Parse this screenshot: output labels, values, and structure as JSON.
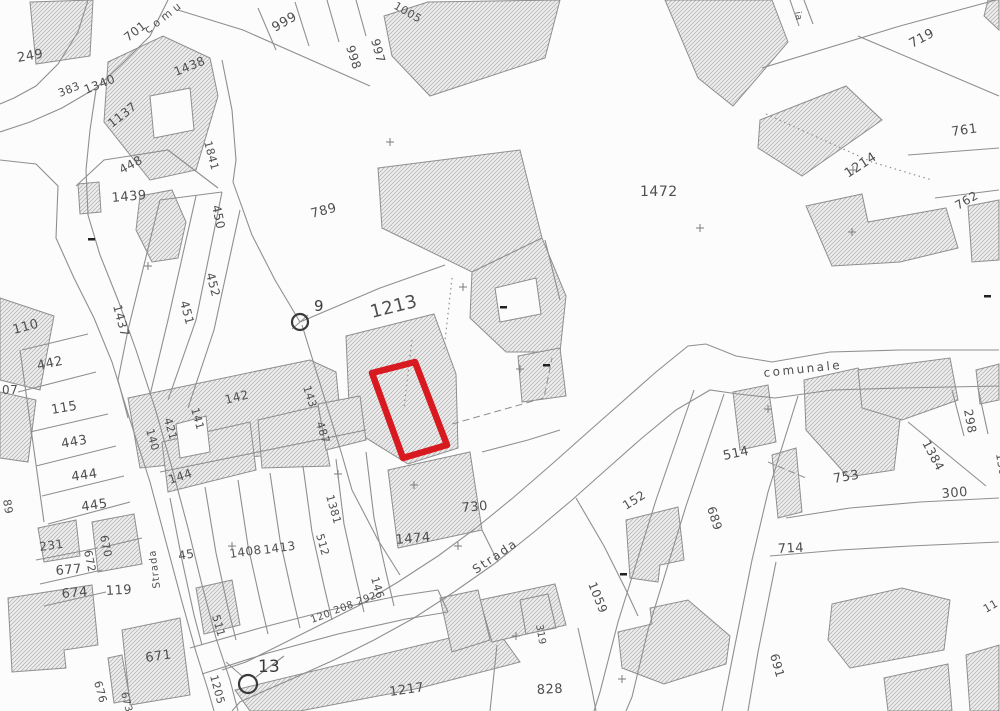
{
  "map": {
    "background": "#fcfcfc",
    "line_color": "#8f8f8f",
    "label_color": "#4f4f4f",
    "strong_label_color": "#3a3a3a",
    "hatch_bg": "#efefef",
    "hatch_stroke": "#b4b4b4",
    "highlight_color": "#d8191f",
    "red_parcel": "372,373 415,362 447,445 403,458",
    "buildings": [
      "30,2 93,0 90,56 36,64",
      "108,62 163,36 210,58 218,96 196,170 150,180 104,122",
      "384,16 428,2 560,0 545,58 430,96 392,56",
      "665,0 772,0 788,42 733,106 698,78",
      "760,120 846,86 882,120 802,176 758,148",
      "806,206 862,194 868,222 946,208 958,248 900,262 832,266",
      "968,206 999,200 999,260 972,262",
      "988,0 999,0 999,30 984,16",
      "378,168 520,150 542,238 472,272 382,228",
      "472,272 542,238 566,296 560,352 506,352 470,318",
      "346,336 434,314 456,374 458,448 408,464 350,428",
      "518,356 560,348 566,396 522,402",
      "388,470 470,452 482,530 398,548",
      "128,398 310,360 336,372 342,432 300,452 140,468",
      "0,298 54,316 40,390 0,380",
      "0,392 36,400 28,462 0,458",
      "78,184 99,182 101,212 80,214",
      "140,196 172,190 186,222 178,258 152,262 136,230",
      "38,528 76,520 80,556 44,562",
      "92,522 134,514 142,564 98,572",
      "8,598 92,585 98,645 64,650 66,668 12,672",
      "122,630 180,618 190,695 130,705",
      "108,658 122,655 130,700 114,703",
      "162,442 250,422 256,470 168,492",
      "258,420 318,406 330,466 262,468",
      "318,404 360,396 366,440 326,450",
      "196,588 232,580 240,625 204,634",
      "235,690 495,627 520,662 420,688 300,711 250,711",
      "480,600 555,584 566,625 492,642",
      "618,632 652,624 650,608 688,600 730,636 726,664 664,684 622,668",
      "832,604 902,588 950,600 944,650 850,668 828,640",
      "884,678 948,664 952,711 888,711",
      "966,655 999,645 999,711 970,711",
      "733,392 768,385 776,442 740,450",
      "804,380 858,368 900,420 894,470 848,477 806,430",
      "858,370 950,358 958,400 902,420 862,408",
      "772,455 796,448 802,512 778,518",
      "976,370 999,364 999,400 980,404",
      "626,520 678,507 684,560 660,565 658,582 630,578",
      "440,598 478,590 490,640 452,652"
    ],
    "holes": [
      "150,96 190,88 194,130 154,138",
      "176,424 206,416 210,452 180,458",
      "495,288 536,278 541,314 500,322"
    ],
    "lines": [
      "88,0 78,32 58,64 36,86 14,98 0,104",
      "168,0 150,36 122,64 96,88 62,108 30,122 0,132",
      "0,160 36,164 58,186 56,238 74,278 94,318 112,362 130,420 150,482 166,542 182,602 196,652 208,690 214,711",
      "96,90 90,130 86,170 88,215 100,255 118,300 136,350 155,408 172,468 188,528 202,585 216,638 230,680 238,711",
      "178,10 243,30 370,86",
      "258,8 276,50",
      "295,2 309,46",
      "327,0 339,42",
      "356,0 366,36",
      "222,60 232,110 236,160 233,182",
      "233,182 252,235 275,280 300,322",
      "76,186 104,160 168,150 218,188",
      "160,200 128,330 118,380 128,418",
      "196,196 168,320 150,395",
      "222,192 196,320 168,400",
      "240,210 214,330 188,408",
      "160,200 222,192",
      "300,322 380,288 445,265",
      "302,325 322,390 342,455 352,490",
      "999,350 900,350 830,352 772,362 736,356 706,344 688,346 656,372 622,402 588,432 552,464 514,497 476,528 438,556 398,582 358,606 318,626 278,646 246,662 222,670",
      "999,386 900,388 832,390 775,398 738,394 710,390 676,410 642,438 608,468 572,500 534,532 494,564 454,592 414,618 374,640 334,660 294,678 262,692 240,702 232,711",
      "190,648 260,628 330,610 398,596 438,590",
      "202,674 268,653 338,634 406,619 448,612",
      "762,68 900,26 996,0",
      "858,36 999,96",
      "908,155 999,148",
      "935,198 999,190",
      "694,390 656,500 618,622 600,692 594,711",
      "724,394 686,506 648,630 632,697 626,711",
      "798,396 768,492 752,560",
      "752,560 734,650 722,711",
      "776,562 758,652 748,711",
      "786,518 850,508 920,502 999,498",
      "770,556 840,550 910,546 999,542",
      "497,645 490,711",
      "578,628 592,690 596,711",
      "170,498 182,560 194,615 202,645",
      "205,487 216,553 228,608 236,640",
      "238,480 248,546 260,600 268,634",
      "270,473 280,540 292,594 300,628",
      "303,466 312,532 324,586 332,620",
      "336,459 344,524 356,578 364,612",
      "366,452 374,518 386,572 394,606",
      "160,472 366,430",
      "22,350 88,334",
      "18,392 96,372",
      "30,432 108,414",
      "36,466 116,446",
      "42,496 124,476",
      "48,524 130,502",
      "20,350 44,522",
      "36,560 98,548",
      "40,584 102,570",
      "44,606 106,592",
      "100,548 142,538",
      "352,490 378,540 400,575",
      "482,452 528,440 560,430",
      "576,498 604,546 626,590 638,616",
      "520,600 548,594 556,628 526,634 520,600",
      "908,422 986,486",
      "952,390 964,436",
      "978,388 988,434",
      "790,0 799,26",
      "804,0 813,24",
      "226,662 242,676",
      "256,677 284,656",
      "292,329 308,315",
      "482,530 498,562",
      "438,590 448,612",
      "545,240 560,300"
    ],
    "dashed": [
      "452,424 544,398 552,358",
      "768,462 806,478"
    ],
    "dotted": [
      "766,114 872,162 932,180",
      "452,278 444,350",
      "412,340 404,408"
    ],
    "labels": [
      {
        "t": "249",
        "x": 18,
        "y": 62,
        "r": -10,
        "s": 13
      },
      {
        "t": "701",
        "x": 128,
        "y": 42,
        "r": -38,
        "s": 12
      },
      {
        "t": "383",
        "x": 60,
        "y": 97,
        "r": -22,
        "s": 11
      },
      {
        "t": "1340",
        "x": 86,
        "y": 94,
        "r": -22,
        "s": 12
      },
      {
        "t": "1438",
        "x": 176,
        "y": 76,
        "r": -22,
        "s": 12
      },
      {
        "t": "1137",
        "x": 112,
        "y": 128,
        "r": -38,
        "s": 12
      },
      {
        "t": "1841",
        "x": 204,
        "y": 142,
        "r": 75,
        "s": 11
      },
      {
        "t": "999",
        "x": 275,
        "y": 32,
        "r": -30,
        "s": 13
      },
      {
        "t": "998",
        "x": 346,
        "y": 47,
        "r": 72,
        "s": 12
      },
      {
        "t": "997",
        "x": 371,
        "y": 40,
        "r": 75,
        "s": 12
      },
      {
        "t": "1005",
        "x": 393,
        "y": 8,
        "r": 30,
        "s": 11
      },
      {
        "t": "719",
        "x": 912,
        "y": 48,
        "r": -28,
        "s": 13
      },
      {
        "t": "ia",
        "x": 795,
        "y": 12,
        "r": 80,
        "s": 9
      },
      {
        "t": "761",
        "x": 952,
        "y": 136,
        "r": -8,
        "s": 13
      },
      {
        "t": "1214",
        "x": 848,
        "y": 178,
        "r": -33,
        "s": 13
      },
      {
        "t": "762",
        "x": 958,
        "y": 210,
        "r": -30,
        "s": 12
      },
      {
        "t": "1472",
        "x": 640,
        "y": 196,
        "r": 0,
        "s": 14
      },
      {
        "t": "789",
        "x": 312,
        "y": 218,
        "r": -15,
        "s": 13
      },
      {
        "t": "1213",
        "x": 372,
        "y": 318,
        "r": -14,
        "s": 18
      },
      {
        "t": "448",
        "x": 122,
        "y": 174,
        "r": -28,
        "s": 12
      },
      {
        "t": "1439",
        "x": 112,
        "y": 202,
        "r": -5,
        "s": 13
      },
      {
        "t": "450",
        "x": 212,
        "y": 206,
        "r": 78,
        "s": 12
      },
      {
        "t": "452",
        "x": 206,
        "y": 274,
        "r": 75,
        "s": 12
      },
      {
        "t": "451",
        "x": 180,
        "y": 302,
        "r": 75,
        "s": 12
      },
      {
        "t": "1437",
        "x": 113,
        "y": 306,
        "r": 75,
        "s": 12
      },
      {
        "t": "110",
        "x": 14,
        "y": 334,
        "r": -15,
        "s": 13
      },
      {
        "t": "442",
        "x": 38,
        "y": 370,
        "r": -12,
        "s": 13
      },
      {
        "t": "07",
        "x": 2,
        "y": 394,
        "r": 0,
        "s": 12
      },
      {
        "t": "115",
        "x": 52,
        "y": 414,
        "r": -10,
        "s": 13
      },
      {
        "t": "443",
        "x": 62,
        "y": 448,
        "r": -10,
        "s": 13
      },
      {
        "t": "444",
        "x": 72,
        "y": 481,
        "r": -8,
        "s": 13
      },
      {
        "t": "445",
        "x": 82,
        "y": 511,
        "r": -8,
        "s": 13
      },
      {
        "t": "89",
        "x": 3,
        "y": 500,
        "r": 80,
        "s": 11
      },
      {
        "t": "140",
        "x": 146,
        "y": 430,
        "r": 74,
        "s": 11
      },
      {
        "t": "421",
        "x": 164,
        "y": 419,
        "r": 74,
        "s": 11
      },
      {
        "t": "141",
        "x": 191,
        "y": 409,
        "r": 74,
        "s": 11
      },
      {
        "t": "142",
        "x": 226,
        "y": 404,
        "r": -14,
        "s": 12
      },
      {
        "t": "143",
        "x": 303,
        "y": 387,
        "r": 72,
        "s": 11
      },
      {
        "t": "487",
        "x": 316,
        "y": 423,
        "r": 72,
        "s": 11
      },
      {
        "t": "144",
        "x": 170,
        "y": 484,
        "r": -18,
        "s": 12
      },
      {
        "t": "45",
        "x": 179,
        "y": 560,
        "r": -10,
        "s": 12
      },
      {
        "t": "1408",
        "x": 230,
        "y": 558,
        "r": -8,
        "s": 12
      },
      {
        "t": "1413",
        "x": 264,
        "y": 554,
        "r": -8,
        "s": 12
      },
      {
        "t": "512",
        "x": 316,
        "y": 535,
        "r": 74,
        "s": 11
      },
      {
        "t": "1381",
        "x": 326,
        "y": 496,
        "r": 74,
        "s": 11
      },
      {
        "t": "511",
        "x": 212,
        "y": 616,
        "r": 74,
        "s": 11
      },
      {
        "t": "146",
        "x": 371,
        "y": 578,
        "r": 74,
        "s": 11
      },
      {
        "t": "120",
        "x": 312,
        "y": 623,
        "r": -20,
        "s": 10
      },
      {
        "t": "208",
        "x": 335,
        "y": 614,
        "r": -20,
        "s": 10
      },
      {
        "t": "292",
        "x": 358,
        "y": 605,
        "r": -20,
        "s": 10
      },
      {
        "t": "231",
        "x": 40,
        "y": 551,
        "r": -8,
        "s": 12
      },
      {
        "t": "670",
        "x": 100,
        "y": 536,
        "r": 78,
        "s": 11
      },
      {
        "t": "672",
        "x": 84,
        "y": 551,
        "r": 78,
        "s": 11
      },
      {
        "t": "677",
        "x": 56,
        "y": 575,
        "r": -5,
        "s": 13
      },
      {
        "t": "674",
        "x": 62,
        "y": 598,
        "r": -5,
        "s": 13
      },
      {
        "t": "119",
        "x": 106,
        "y": 595,
        "r": -3,
        "s": 13
      },
      {
        "t": "671",
        "x": 146,
        "y": 662,
        "r": -8,
        "s": 13
      },
      {
        "t": "676",
        "x": 94,
        "y": 682,
        "r": 75,
        "s": 11
      },
      {
        "t": "673",
        "x": 121,
        "y": 693,
        "r": 75,
        "s": 10
      },
      {
        "t": "730",
        "x": 462,
        "y": 512,
        "r": -5,
        "s": 13
      },
      {
        "t": "1474",
        "x": 396,
        "y": 544,
        "r": -5,
        "s": 13
      },
      {
        "t": "1059",
        "x": 588,
        "y": 584,
        "r": 68,
        "s": 12
      },
      {
        "t": "319",
        "x": 536,
        "y": 625,
        "r": 80,
        "s": 10
      },
      {
        "t": "828",
        "x": 537,
        "y": 694,
        "r": -3,
        "s": 13
      },
      {
        "t": "1217",
        "x": 390,
        "y": 696,
        "r": -8,
        "s": 13
      },
      {
        "t": "1205",
        "x": 210,
        "y": 676,
        "r": 75,
        "s": 11
      },
      {
        "t": "514",
        "x": 724,
        "y": 460,
        "r": -12,
        "s": 13
      },
      {
        "t": "689",
        "x": 707,
        "y": 508,
        "r": 72,
        "s": 12
      },
      {
        "t": "753",
        "x": 834,
        "y": 483,
        "r": -10,
        "s": 13
      },
      {
        "t": "1384",
        "x": 922,
        "y": 443,
        "r": 62,
        "s": 12
      },
      {
        "t": "298",
        "x": 964,
        "y": 410,
        "r": 80,
        "s": 12
      },
      {
        "t": "130",
        "x": 996,
        "y": 454,
        "r": 80,
        "s": 11
      },
      {
        "t": "300",
        "x": 942,
        "y": 498,
        "r": -5,
        "s": 13
      },
      {
        "t": "714",
        "x": 778,
        "y": 553,
        "r": -3,
        "s": 13
      },
      {
        "t": "691",
        "x": 770,
        "y": 655,
        "r": 74,
        "s": 12
      },
      {
        "t": "152",
        "x": 626,
        "y": 510,
        "r": -32,
        "s": 12
      },
      {
        "t": "11",
        "x": 986,
        "y": 613,
        "r": -30,
        "s": 11
      }
    ],
    "street_labels": [
      {
        "t": "comu",
        "x": 148,
        "y": 34,
        "r": -38,
        "s": 11,
        "ls": 4
      },
      {
        "t": "comunale",
        "x": 764,
        "y": 377,
        "r": -6,
        "s": 12,
        "ls": 2.5
      },
      {
        "t": "Strada",
        "x": 476,
        "y": 574,
        "r": -34,
        "s": 12,
        "ls": 2
      },
      {
        "t": "Strada",
        "x": 160,
        "y": 588,
        "r": -97,
        "s": 10,
        "ls": 1
      }
    ],
    "survey_points": [
      {
        "x": 300,
        "y": 322,
        "rad": 8,
        "label": "9",
        "lx": 314,
        "ly": 311,
        "fs": 15
      },
      {
        "x": 248,
        "y": 684,
        "rad": 9,
        "label": "13",
        "lx": 258,
        "ly": 672,
        "fs": 17
      }
    ],
    "crosses": [
      [
        148,
        266
      ],
      [
        390,
        142
      ],
      [
        463,
        287
      ],
      [
        520,
        369
      ],
      [
        768,
        409
      ],
      [
        853,
        170
      ],
      [
        852,
        232
      ],
      [
        414,
        485
      ],
      [
        622,
        679
      ],
      [
        232,
        546
      ],
      [
        516,
        636
      ],
      [
        338,
        474
      ],
      [
        700,
        228
      ],
      [
        458,
        546
      ]
    ],
    "marks": [
      [
        543,
        364
      ],
      [
        620,
        573
      ],
      [
        500,
        306
      ],
      [
        88,
        238
      ],
      [
        984,
        295
      ]
    ]
  }
}
